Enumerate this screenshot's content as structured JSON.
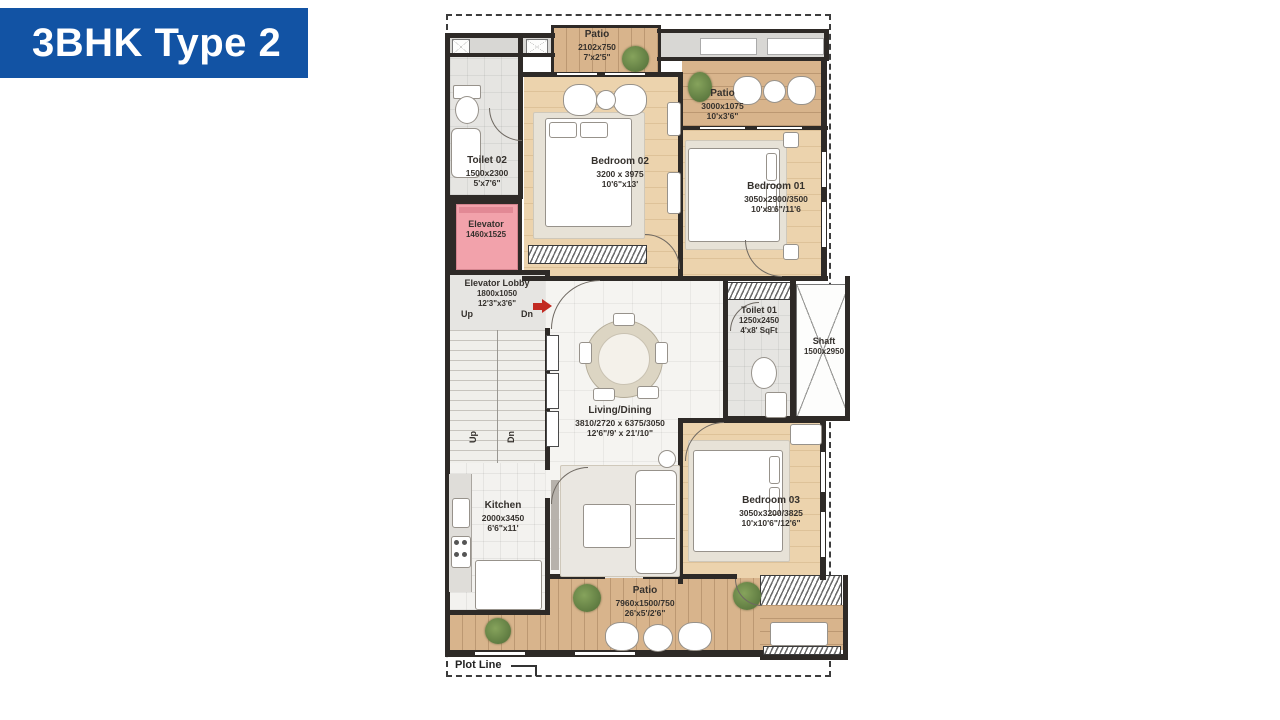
{
  "banner": {
    "title": "3BHK Type 2",
    "bg": "#1253a4"
  },
  "plot": {
    "label": "Plot Line"
  },
  "stairs": {
    "up": "Up",
    "dn": "Dn"
  },
  "colors": {
    "wall": "#2e2a27",
    "bedroom_wood": "#ecd3ad",
    "patio_wood": "#d8b48c",
    "elevator_pink": "#f2a2ab",
    "entry_arrow": "#c22a22"
  },
  "rooms": {
    "patioTop": {
      "name": "Patio",
      "mm": "2102x750",
      "ft": "7'x2'5\""
    },
    "patioRight": {
      "name": "Patio",
      "mm": "3000x1075",
      "ft": "10'x3'6\""
    },
    "toilet02": {
      "name": "Toilet 02",
      "mm": "1500x2300",
      "ft": "5'x7'6\""
    },
    "bedroom02": {
      "name": "Bedroom 02",
      "mm": "3200 x 3975",
      "ft": "10'6\"x13'"
    },
    "bedroom01": {
      "name": "Bedroom 01",
      "mm": "3050x2900/3500",
      "ft": "10'x9'6\"/11'6"
    },
    "elevator": {
      "name": "Elevator",
      "mm": "1460x1525"
    },
    "elevatorLobby": {
      "name": "Elevator Lobby",
      "mm": "1800x1050",
      "ft": "12'3\"x3'6\"",
      "up": "Up",
      "dn": "Dn"
    },
    "toilet01": {
      "name": "Toilet 01",
      "mm": "1250x2450",
      "ft": "4'x8' SqFt"
    },
    "shaft": {
      "name": "Shaft",
      "mm": "1500x2950"
    },
    "livingDining": {
      "name": "Living/Dining",
      "mm": "3810/2720 x 6375/3050",
      "ft": "12'6\"/9' x 21'/10\""
    },
    "kitchen": {
      "name": "Kitchen",
      "mm": "2000x3450",
      "ft": "6'6\"x11'"
    },
    "bedroom03": {
      "name": "Bedroom 03",
      "mm": "3050x3200/3825",
      "ft": "10'x10'6\"/12'6\""
    },
    "patioBottom": {
      "name": "Patio",
      "mm": "7960x1500/750",
      "ft": "26'x5'/2'6\""
    }
  }
}
